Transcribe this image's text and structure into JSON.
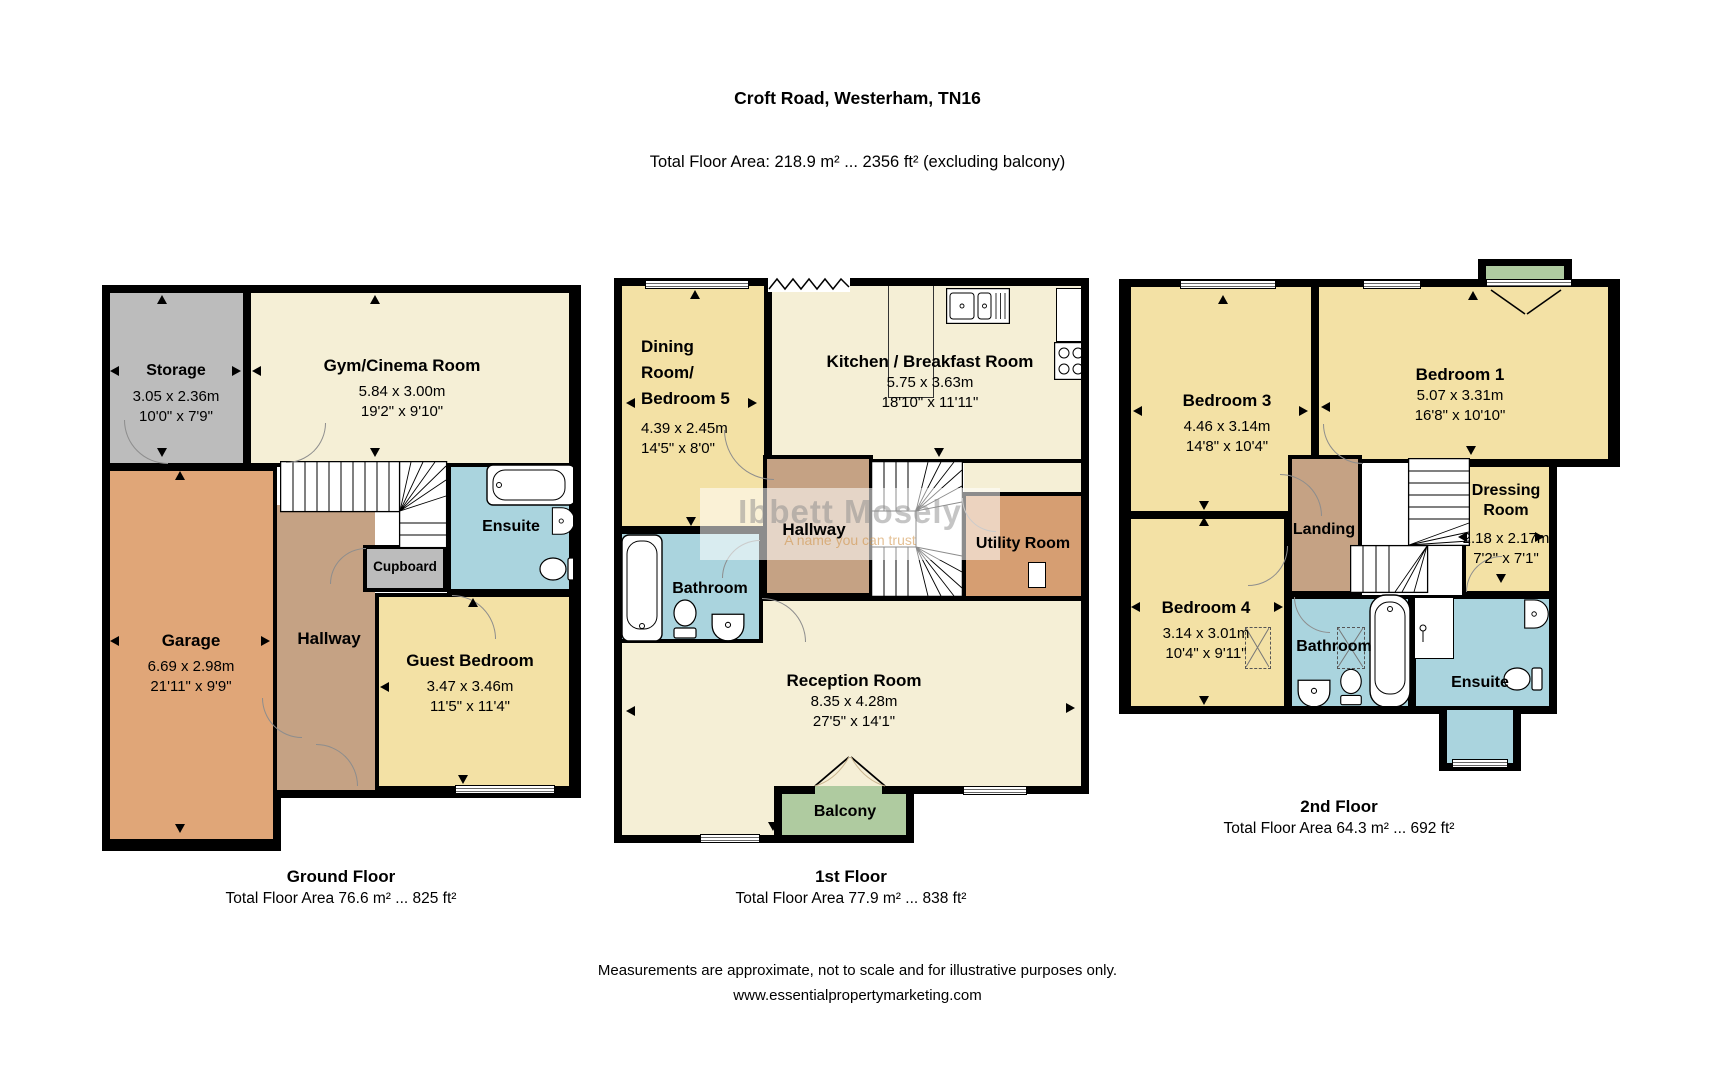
{
  "title": "Croft Road, Westerham, TN16",
  "subtitle": "Total Floor Area: 218.9 m² ... 2356 ft² (excluding balcony)",
  "watermark": {
    "name": "Ibbett Mosely",
    "tagline": "A name you can trust"
  },
  "footer": {
    "line1": "Measurements are approximate, not to scale and for illustrative purposes only.",
    "line2": "www.essentialpropertymarketing.com"
  },
  "colors": {
    "wall": "#000000",
    "room_cream": "#F5EFD6",
    "room_yellow": "#F3E1A5",
    "room_gray": "#BCBCBC",
    "room_garage": "#E0A678",
    "room_hall": "#C5A284",
    "room_utility": "#D69E72",
    "room_bath": "#AAD4DE",
    "room_balcony": "#AFCBA0"
  },
  "floors": {
    "ground": {
      "caption_title": "Ground Floor",
      "caption_area": "Total Floor Area 76.6 m² ... 825 ft²",
      "rooms": {
        "storage": {
          "name": "Storage",
          "metric": "3.05 x 2.36m",
          "imperial": "10'0\" x 7'9\""
        },
        "gym": {
          "name": "Gym/Cinema Room",
          "metric": "5.84 x 3.00m",
          "imperial": "19'2\" x 9'10\""
        },
        "garage": {
          "name": "Garage",
          "metric": "6.69 x 2.98m",
          "imperial": "21'11\" x 9'9\""
        },
        "hallway": {
          "name": "Hallway"
        },
        "cupboard": {
          "name": "Cupboard"
        },
        "ensuite": {
          "name": "Ensuite"
        },
        "guest": {
          "name": "Guest Bedroom",
          "metric": "3.47 x 3.46m",
          "imperial": "11'5\" x 11'4\""
        }
      }
    },
    "first": {
      "caption_title": "1st Floor",
      "caption_area": "Total Floor Area 77.9 m² ... 838 ft²",
      "rooms": {
        "dining": {
          "name1": "Dining",
          "name2": "Room/",
          "name3": "Bedroom 5",
          "metric": "4.39 x 2.45m",
          "imperial": "14'5\" x 8'0\""
        },
        "kitchen": {
          "name": "Kitchen / Breakfast Room",
          "metric": "5.75 x 3.63m",
          "imperial": "18'10\" x 11'11\""
        },
        "hallway": {
          "name": "Hallway"
        },
        "utility": {
          "name": "Utility Room"
        },
        "bathroom": {
          "name": "Bathroom"
        },
        "reception": {
          "name": "Reception Room",
          "metric": "8.35 x 4.28m",
          "imperial": "27'5\" x 14'1\""
        },
        "balcony": {
          "name": "Balcony"
        }
      }
    },
    "second": {
      "caption_title": "2nd Floor",
      "caption_area": "Total Floor Area 64.3 m² ... 692 ft²",
      "rooms": {
        "bedroom3": {
          "name": "Bedroom 3",
          "metric": "4.46 x 3.14m",
          "imperial": "14'8\" x 10'4\""
        },
        "bedroom1": {
          "name": "Bedroom 1",
          "metric": "5.07 x 3.31m",
          "imperial": "16'8\" x 10'10\""
        },
        "bedroom4": {
          "name": "Bedroom 4",
          "metric": "3.14 x 3.01m",
          "imperial": "10'4\" x 9'11\""
        },
        "landing": {
          "name": "Landing"
        },
        "dressing": {
          "name1": "Dressing",
          "name2": "Room",
          "metric": "2.18 x 2.17m",
          "imperial": "7'2\" x 7'1\""
        },
        "bathroom": {
          "name": "Bathroom"
        },
        "ensuite": {
          "name": "Ensuite"
        }
      }
    }
  }
}
